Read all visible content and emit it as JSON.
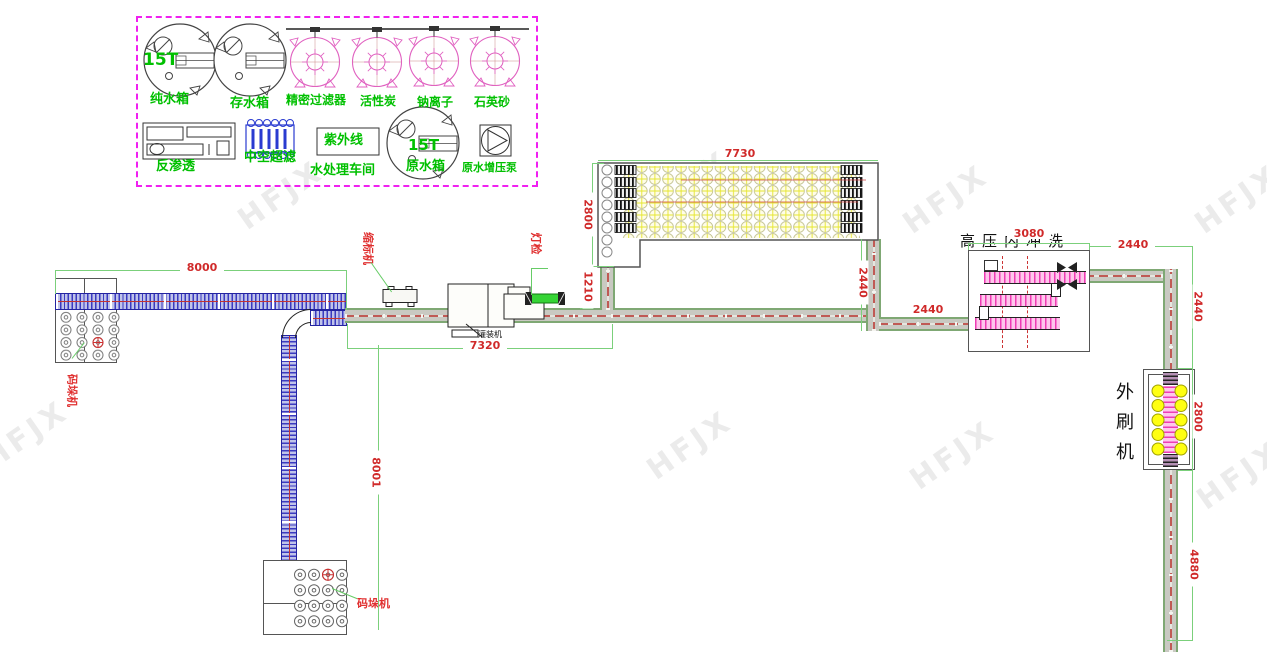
{
  "watermark": {
    "text": "HFJX"
  },
  "legend": {
    "tank1_capacity": "15T",
    "raw_tank_capacity": "15T",
    "labels": {
      "pure_water_tank": "纯水箱",
      "storage_tank": "存水箱",
      "precision_filter": "精密过滤器",
      "activated_carbon": "活性炭",
      "sodium_ion": "钠离子",
      "quartz_sand": "石英砂",
      "reverse_osmosis": "反渗透",
      "hollow_ultrafiltration": "中空超滤",
      "uv": "紫外线",
      "workshop": "水处理车间",
      "raw_water_tank": "原水箱",
      "raw_water_booster_pump": "原水增压泵"
    }
  },
  "machines": {
    "shrink_labeler": "缩标机",
    "lamp_inspection": "灯检",
    "filler": "灌装机",
    "high_pressure_internal_wash": "高压内冲洗",
    "external_brusher": "外刷机",
    "palletizer_left": "码垛机",
    "palletizer_bottom": "码垛机"
  },
  "dims": {
    "d8000": "8000",
    "d7730": "7730",
    "d2800_table": "2800",
    "d1210": "1210",
    "d7320": "7320",
    "d2440_drop": "2440",
    "d2440_wash_in": "2440",
    "d3080": "3080",
    "d2440_top_right": "2440",
    "d2440_right": "2440",
    "d2800_brush": "2800",
    "d4880": "4880",
    "d8001": "8001"
  }
}
